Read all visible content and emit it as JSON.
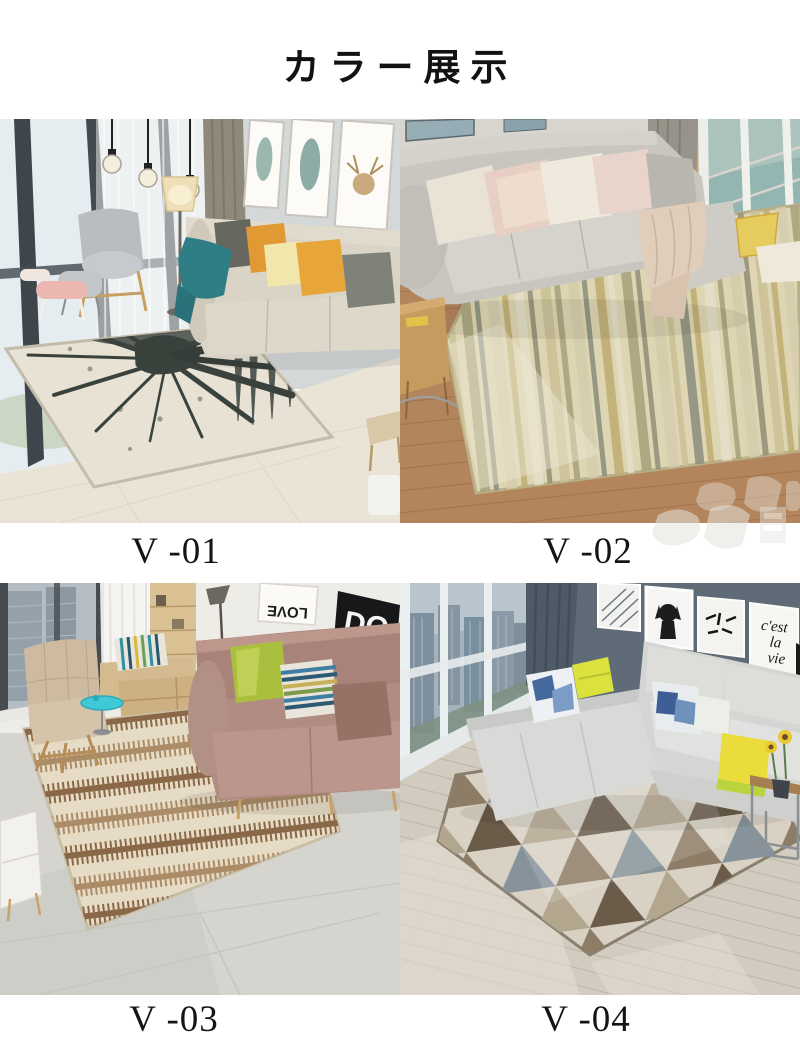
{
  "page": {
    "title": "カラー展示",
    "background": "#ffffff",
    "text_color": "#121212",
    "watermark_color": "#e2e2de"
  },
  "variants": [
    {
      "label": "V -01",
      "rug": {
        "base": "#e8e2d4",
        "pattern": "#3a423d",
        "style": "ink-splash-burst"
      }
    },
    {
      "label": "V -02",
      "rug": {
        "base": "#ded6b2",
        "pattern": "#8d9180",
        "style": "vertical-stripes"
      }
    },
    {
      "label": "V -03",
      "rug": {
        "base": "#e6dcc6",
        "pattern": "#8a6847",
        "style": "frayed-stripes"
      },
      "posters": [
        "DO",
        "LOVE"
      ]
    },
    {
      "label": "V -04",
      "rug": {
        "base": "#d9d2c4",
        "pattern": "#8d7c66",
        "style": "triangle-mosaic"
      },
      "posters": [
        "c'est",
        "la",
        "vie"
      ]
    }
  ]
}
